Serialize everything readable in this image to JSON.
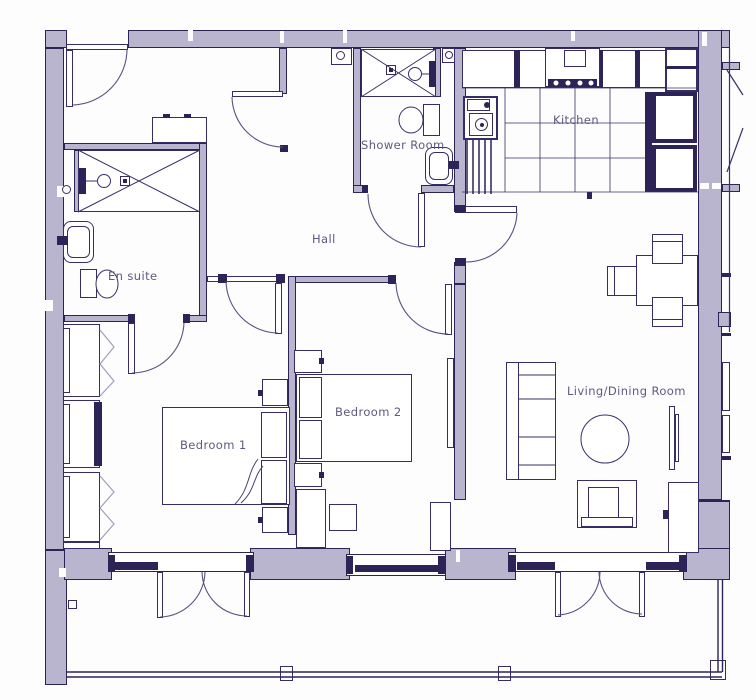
{
  "title": "Apartment floor plan",
  "colors": {
    "wall_fill": "#b9b5cf",
    "line": "#2d2357",
    "label_text": "#5f5980",
    "background": "#fdfdfd"
  },
  "rooms": {
    "en_suite": {
      "label": "En suite"
    },
    "hall": {
      "label": "Hall"
    },
    "shower_room": {
      "label": "Shower Room"
    },
    "kitchen": {
      "label": "Kitchen"
    },
    "bedroom1": {
      "label": "Bedroom 1"
    },
    "bedroom2": {
      "label": "Bedroom 2"
    },
    "living_dining": {
      "label": "Living/Dining Room"
    }
  },
  "fixtures": [
    "shower-tray-icon",
    "shower-head-icon",
    "toilet-icon",
    "sink-icon",
    "boiler-icon",
    "hob-icon",
    "bed-icon",
    "wardrobe-icon",
    "sofa-icon",
    "armchair-icon",
    "coffee-table-icon",
    "dining-table-icon",
    "tv-unit-icon",
    "balcony-railing-icon",
    "door-swing-icon",
    "window-icon"
  ]
}
